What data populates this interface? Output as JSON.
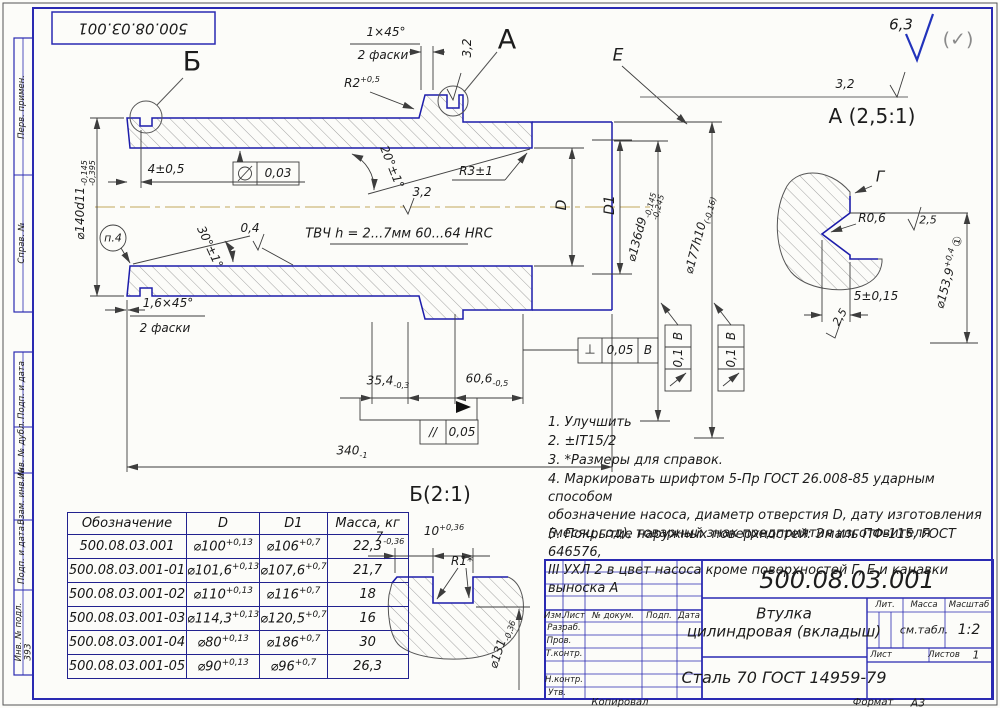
{
  "sheet": {
    "top_doc_number": "500.08.03.001",
    "copied": "Копировал",
    "format_label": "Формат",
    "format_value": "А3",
    "inv_value": "393",
    "margin_labels": [
      "Перв. примен.",
      "Справ. №",
      "Подп. и дата",
      "Инв. № дубл.",
      "Взам. инв. №",
      "Подп. и дата",
      "Инв. № подл."
    ]
  },
  "corner": {
    "roughness": "6,3",
    "alt": "(✓)"
  },
  "main": {
    "label_b": "Б",
    "label_a": "А",
    "label_e": "Е",
    "chamfer1": "1×45°",
    "chamfer1_note": "2 фаски",
    "r2_base": "R2",
    "r2_sup": "+0,5",
    "rough_groove": "3,2",
    "rough_e": "3,2",
    "rough_bore": "3,2",
    "rough_cone": "0,4",
    "dim4": "4±0,5",
    "cyl_tol": "0,03",
    "angle30": "30°±1°",
    "angle20": "20°±1°",
    "r3": "R3±1",
    "p4": "п.4",
    "tvch": "ТВЧ h = 2...7мм 60...64 HRC",
    "chamfer2": "1,6×45°",
    "chamfer2_note": "2 фаски",
    "d140_base": "⌀140d11",
    "d140_up": "-0,145",
    "d140_dn": "-0,395",
    "d_label": "D",
    "d1_label": "D1",
    "d136_base": "⌀136d9",
    "d136_up": "-0,145",
    "d136_dn": "-0,245",
    "d177_base": "⌀177h10",
    "d177_tol": "(-0,16)",
    "dim354_base": "35,4",
    "dim354_tol": "-0,3",
    "dim606_base": "60,6",
    "dim606_tol": "-0,5",
    "dim340_base": "340",
    "dim340_tol": "-1",
    "perp_sym": "⊥",
    "perp_val": "0,05",
    "perp_ref": "В",
    "par_sym": "//",
    "par_val": "0,05",
    "runout_val": "0,1",
    "runout_ref": "В"
  },
  "detail_a": {
    "title": "А (2,5:1)",
    "label_g": "Г",
    "r06": "R0,6",
    "rough1": "2,5",
    "rough2": "2,5",
    "dim5": "5±0,15",
    "d_base": "⌀153,9",
    "d_sup": "+0,4",
    "d_mark": "①"
  },
  "detail_b": {
    "title": "Б(2:1)",
    "dim7_base": "7",
    "dim7_tol": "-0,36",
    "dim10_base": "10",
    "dim10_tol": "+0,36",
    "r1": "R1*",
    "d_base": "⌀131",
    "d_tol": "-0,36"
  },
  "notes": [
    "1. Улучшить",
    "2. ±IT15/2",
    "3. *Размеры для справок.",
    "4. Маркировать шрифтом 5-Пр ГОСТ 26.008-85 ударным способом\nобозначение насоса, диаметр отверстия D, дату изготовления\n(месяц,год), товарный знак предприятия изготовителя",
    "5. Покрытие наружных поверхностей: Эмаль ПФ-115, ГОСТ 646576,\nIII УХЛ 2 в цвет насоса кроме поверхностей Г, Е и канавки выноска А"
  ],
  "table": {
    "headers": [
      "Обозначение",
      "D",
      "D1",
      "Масса, кг"
    ],
    "rows": [
      {
        "name": "500.08.03.001",
        "d": "⌀100",
        "dt": "+0,13",
        "d1": "⌀106",
        "d1t": "+0,7",
        "m": "22,3"
      },
      {
        "name": "500.08.03.001-01",
        "d": "⌀101,6",
        "dt": "+0,13",
        "d1": "⌀107,6",
        "d1t": "+0,7",
        "m": "21,7"
      },
      {
        "name": "500.08.03.001-02",
        "d": "⌀110",
        "dt": "+0,13",
        "d1": "⌀116",
        "d1t": "+0,7",
        "m": "18"
      },
      {
        "name": "500.08.03.001-03",
        "d": "⌀114,3",
        "dt": "+0,13",
        "d1": "⌀120,5",
        "d1t": "+0,7",
        "m": "16"
      },
      {
        "name": "500.08.03.001-04",
        "d": "⌀80",
        "dt": "+0,13",
        "d1": "⌀186",
        "d1t": "+0,7",
        "m": "30"
      },
      {
        "name": "500.08.03.001-05",
        "d": "⌀90",
        "dt": "+0,13",
        "d1": "⌀96",
        "d1t": "+0,7",
        "m": "26,3"
      }
    ]
  },
  "titleblock": {
    "doc_number": "500.08.03.001",
    "name1": "Втулка",
    "name2": "цилиндровая (вкладыш)",
    "material": "Сталь 70 ГОСТ 14959-79",
    "col_izm": "Изм.",
    "col_list": "Лист",
    "col_doc": "№ докум.",
    "col_podp": "Подп.",
    "col_data": "Дата",
    "row1": "Разраб.",
    "row2": "Пров.",
    "row3": "Т.контр.",
    "row4": "Н.контр.",
    "row5": "Утв.",
    "lit": "Лит.",
    "mass": "Масса",
    "scale": "Масштаб",
    "mass_val": "см.табл.",
    "scale_val": "1:2",
    "sheet_label": "Лист",
    "sheets_label": "Листов",
    "sheets_val": "1"
  }
}
